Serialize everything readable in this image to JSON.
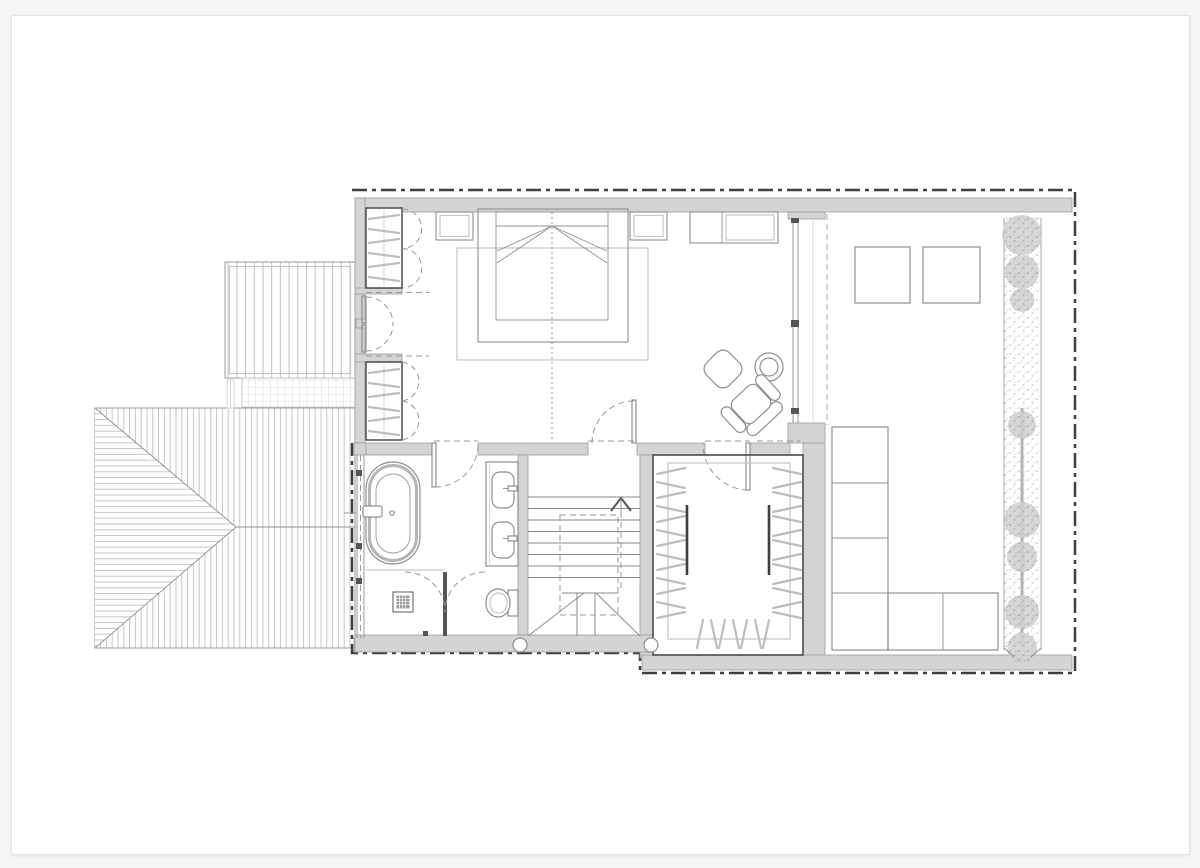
{
  "document": {
    "kind": "architectural-floor-plan",
    "visible_text": [],
    "notes": "line drawing only, no labels or dimensions rendered"
  },
  "colors": {
    "page-bg": "#f5f5f6",
    "paper": "#ffffff",
    "paper-border": "#e3e3e6",
    "wall-fill": "#d4d4d4",
    "wall-edge": "#9b9b9b",
    "line-dark": "#4a4a4a",
    "line-mid": "#8f8f8f",
    "line-light": "#c6c6c6",
    "dash": "#999999",
    "outline": "#3f3f3f",
    "hatch": "#bdbdbd",
    "plant": "#c9c9c9"
  },
  "elements": [
    "section-outline-dashdot",
    "hip-roof",
    "deck",
    "trellis-grid",
    "bedroom-bed",
    "nightstand-left",
    "nightstand-right",
    "dresser",
    "rug",
    "wardrobe-upper",
    "wardrobe-lower",
    "french-door",
    "armchair",
    "ottoman",
    "side-table",
    "bathroom-bathtub",
    "bathtub-faucet",
    "vanity-two-sinks",
    "shower-drain",
    "shower-partition",
    "toilet",
    "window-strip",
    "stair-treads",
    "stair-up-arrow",
    "stair-void-dashed",
    "walk-in-closet",
    "closet-rails",
    "closet-hanger-ticks",
    "structural-columns",
    "terrace",
    "terrace-glazing",
    "skylight-left",
    "skylight-right",
    "planter-modules-L",
    "plant-strip",
    "hedge-line",
    "trees"
  ]
}
